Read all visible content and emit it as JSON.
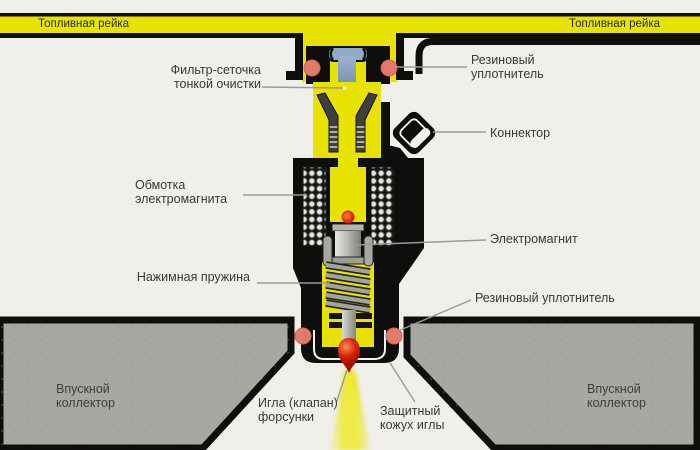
{
  "diagram": {
    "fuel_rail": {
      "left_label": "Топливная рейка",
      "right_label": "Топливная рейка"
    },
    "labels": {
      "filter": "Фильтр-сеточка\nтонкой очистки",
      "seal_top": "Резиновый\nуплотнитель",
      "connector": "Коннектор",
      "coil": "Обмотка\nэлектромагнита",
      "electromagnet": "Электромагнит",
      "spring": "Нажимная пружина",
      "seal_bottom": "Резиновый уплотнитель",
      "needle": "Игла (клапан)\nфорсунки",
      "sheath": "Защитный\nкожух иглы",
      "intake_left": "Впускной\nколлектор",
      "intake_right": "Впускной\nколлектор"
    },
    "colors": {
      "background": "#f0efe9",
      "rail_yellow": "#e8e203",
      "body_black": "#0e0e0c",
      "rubber_seal": "#e2796a",
      "manifold_gray": "#a8a8a2",
      "needle_red": "#d42300",
      "filter_blue": "#92a9c8",
      "spray_yellow": "#e9e41c",
      "label_text": "#3a3a35",
      "leader_line": "#9b9b95"
    }
  }
}
